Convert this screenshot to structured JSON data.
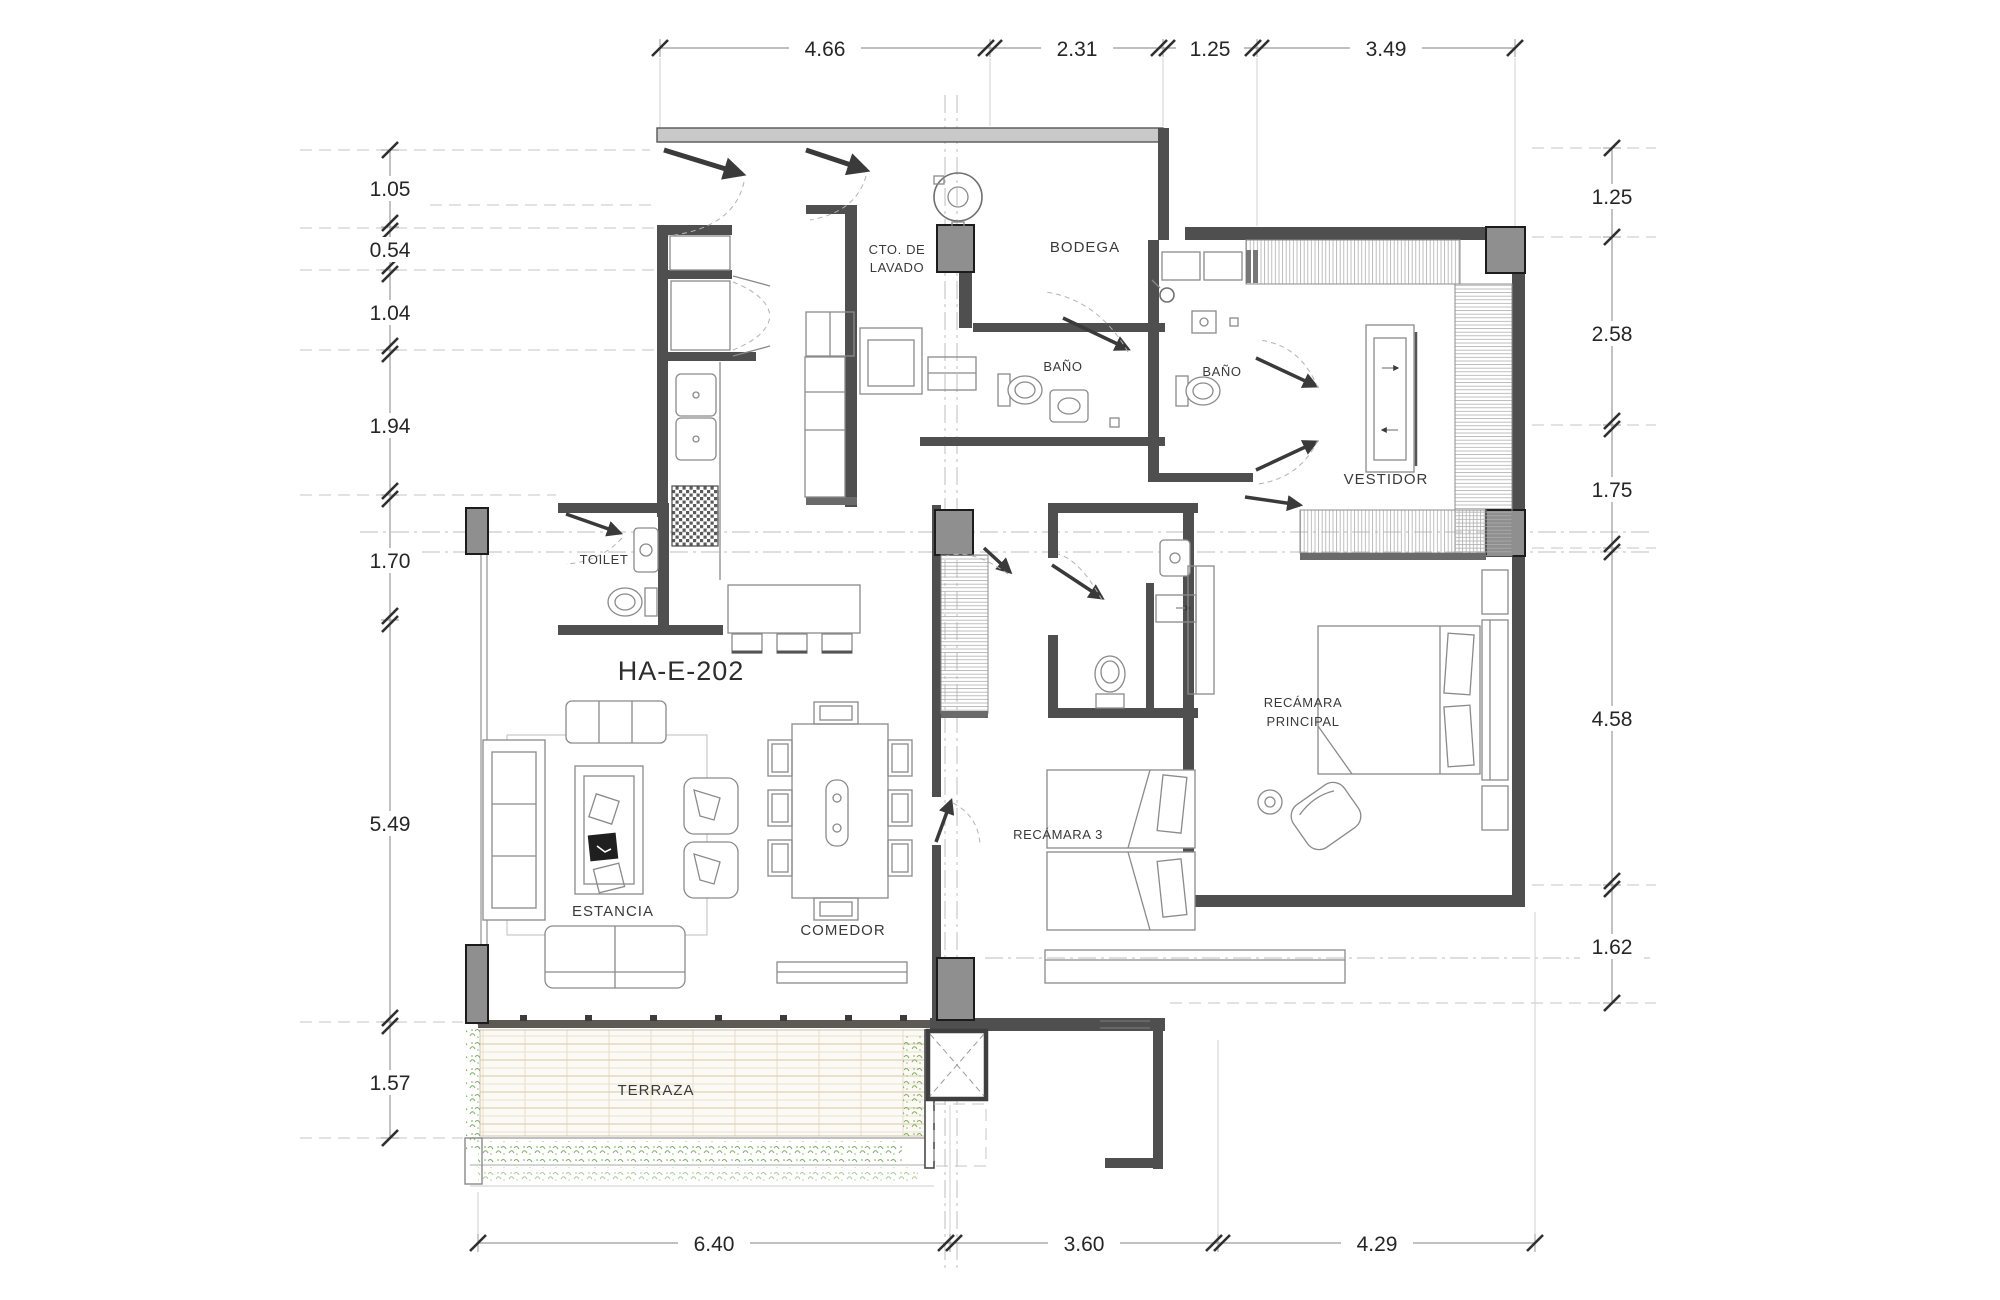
{
  "title": "Architectural floor plan",
  "unit": {
    "label": "HA-E-202"
  },
  "rooms": {
    "cto_lavado_line1": "CTO. DE",
    "cto_lavado_line2": "LAVADO",
    "bodega": "BODEGA",
    "bano_1": "BAÑO",
    "bano_2": "BAÑO",
    "vestidor": "VESTIDOR",
    "toilet": "TOILET",
    "estancia": "ESTANCIA",
    "comedor": "COMEDOR",
    "recamara_3": "RECÁMARA 3",
    "recamara_principal_line1": "RECÁMARA",
    "recamara_principal_line2": "PRINCIPAL",
    "terraza": "TERRAZA"
  },
  "dimensions": {
    "top": [
      "4.66",
      "2.31",
      "1.25",
      "3.49"
    ],
    "bottom": [
      "6.40",
      "3.60",
      "4.29"
    ],
    "left": [
      "1.05",
      "0.54",
      "1.04",
      "1.94",
      "1.70",
      "5.49",
      "1.57"
    ],
    "right": [
      "1.25",
      "2.58",
      "1.75",
      "4.58",
      "1.62"
    ]
  },
  "colors": {
    "background": "#ffffff",
    "wall": "#4f4f4f",
    "column_fill": "#8f8f8f",
    "furniture_line": "#8a8a8a",
    "closet_hatch": "#adadad",
    "deck_wood": "#d8c5a5",
    "vegetation": "#7fae63",
    "dimension_text": "#262626",
    "reference_line": "#c6c6c6"
  }
}
